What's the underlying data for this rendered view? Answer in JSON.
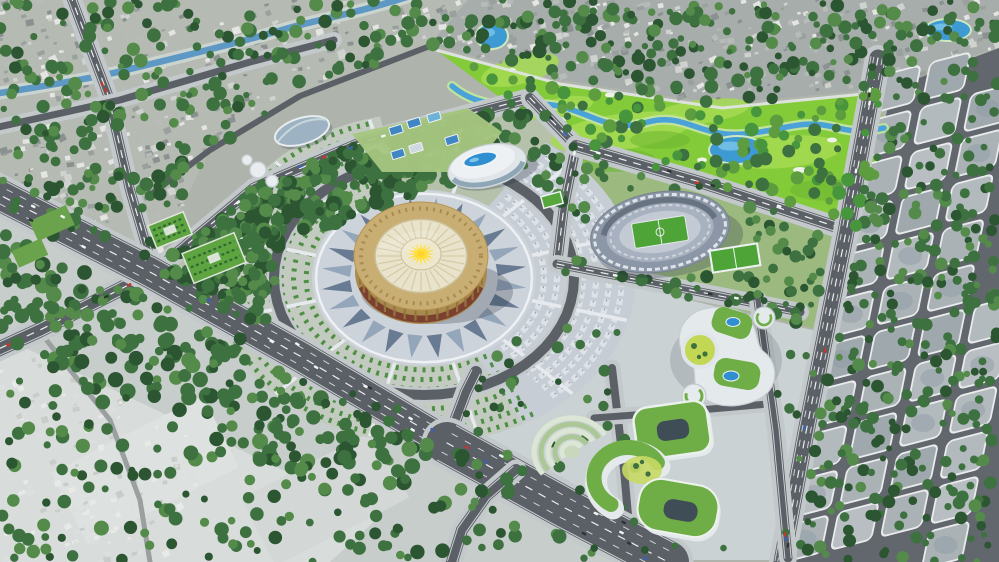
{
  "scene": {
    "type": "aerial-3d-masterplan-render",
    "landmarks": [
      {
        "id": "golden-arena"
      },
      {
        "id": "central-plaza"
      },
      {
        "id": "football-stadium"
      },
      {
        "id": "aquatic-center"
      },
      {
        "id": "multipurpose-hall"
      },
      {
        "id": "golf-course"
      },
      {
        "id": "golf-river"
      },
      {
        "id": "green-roof-campus"
      },
      {
        "id": "amphitheater-garden"
      },
      {
        "id": "tennis-courts"
      },
      {
        "id": "training-pitch"
      },
      {
        "id": "parterre-gardens"
      },
      {
        "id": "old-town"
      },
      {
        "id": "city-grid"
      },
      {
        "id": "main-boulevard"
      },
      {
        "id": "ring-road"
      },
      {
        "id": "canal"
      },
      {
        "id": "village-fields"
      }
    ]
  },
  "colors": {
    "base": "#aeb4ab",
    "old_city": "#b5bab3",
    "old_city_dark": "#a7adaa",
    "golf": "#84cb3a",
    "golf_light": "#a4da52",
    "golf_dark": "#6cb62f",
    "park": "#b5c1aa",
    "stadium_zone": "#9cba80",
    "campus_ground": "#cbd2d4",
    "southwest": "#c7cdca",
    "pale": "#d8dcda",
    "grid_bg": "#62676d",
    "block": "#b2b9bd",
    "block_edge": "#e9ebec",
    "road": "#5b6066",
    "sidewalk": "#c3c8cb",
    "line": "#eceef0",
    "canal": "#5e98c4",
    "river": "#4aa2d8",
    "pond": "#3d9ad2",
    "wall": "#e0e4e3",
    "tree1": "#2c5631",
    "tree2": "#3e7140",
    "tree3": "#548b4a",
    "tree4": "#47953c",
    "shrub": "#4f8f45",
    "plaza": "#ccd3da",
    "wedgeE": "#c6cdd5",
    "wedgeW": "#c3cbc0",
    "orn1": "#5d7189",
    "orn2": "#8ea1b5",
    "gold": "#c9ae74",
    "gold_dark": "#a8894e",
    "gold_line": "#a98b4e",
    "cream": "#e9e3cb",
    "cream_line": "#d4caa6",
    "sun": "#ffdf3a",
    "frieze": "#7c4030",
    "stand": "#8b97a6",
    "tier": "#a7b1bf",
    "track": "#c3cad4",
    "pitch": "#4fa437",
    "white_bld": "#e9edf0",
    "pool": "#2f8fd0",
    "campus_white": "#e4e9ec",
    "roof_green": "#6fae46",
    "lawn": "#c2d855",
    "hole": "#3f4d56",
    "court": "#3f86c2",
    "car_white": "#f2f4f6",
    "car_dark": "#2e3338",
    "car_red": "#c0392b",
    "car_blue": "#3a62b0",
    "shadow": "rgba(35,45,60,0.25)"
  }
}
